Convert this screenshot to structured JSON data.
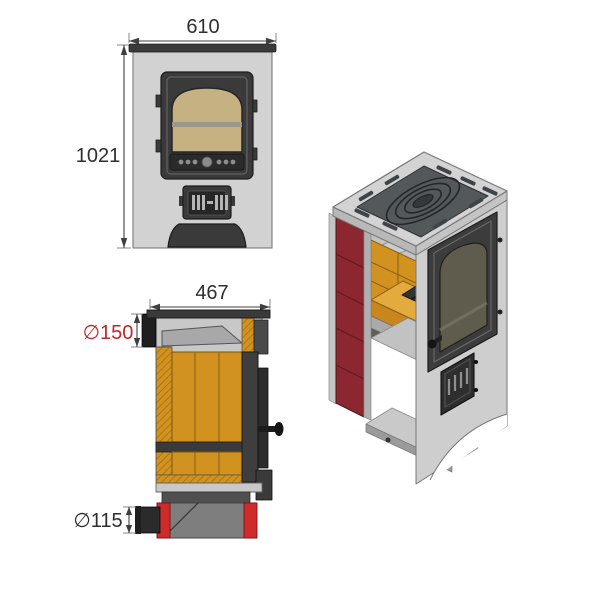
{
  "drawing": {
    "title": "Wood stove technical drawing",
    "front_view": {
      "width_label": "610",
      "height_label": "1021"
    },
    "side_view": {
      "depth_label": "467",
      "flue_diameter_label": "∅150",
      "air_inlet_diameter_label": "∅115"
    },
    "iso_view": {
      "description": "3D cutaway"
    }
  },
  "colors": {
    "dim_text": "#2e2e2e",
    "dim_red": "#c5262c",
    "body_gray": "#d2d2d2",
    "body_gray_dark": "#b8b8b8",
    "metal_dark": "#3a3a3a",
    "metal_darker": "#1f1f1f",
    "glass_tan": "#c6b183",
    "brick_orange": "#d2921f",
    "brick_orange_light": "#e3ab3e",
    "brick_orange_dark": "#c8861c",
    "tile_maroon": "#8c2630",
    "inlet_red": "#cf2b2b",
    "baffle_gray": "#a8a8a8",
    "chamber_gray": "#c8c8c8"
  }
}
